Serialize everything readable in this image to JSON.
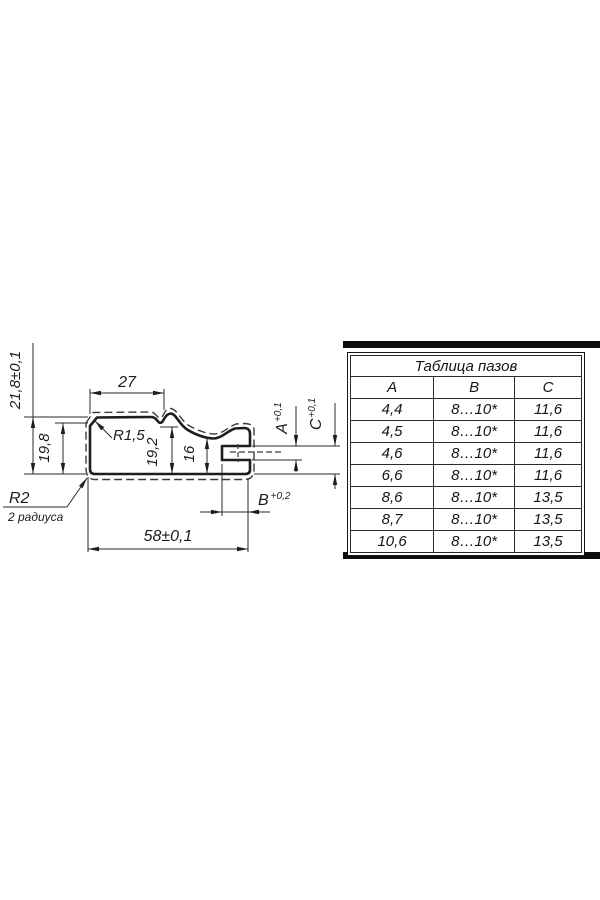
{
  "meta": {
    "background": "#ffffff",
    "line_color": "#1e1e1e",
    "description": "profile-cross-section-drawing"
  },
  "drawing": {
    "dims": {
      "height_total": "21,8±0,1",
      "height_left": "19,8",
      "top_width": "27",
      "radius_top": "R1,5",
      "step_height": "19,2",
      "nose_height": "16",
      "slot_a": {
        "letter": "A",
        "tol": "+0,1"
      },
      "slot_c": {
        "letter": "C",
        "tol": "+0,1"
      },
      "slot_b": {
        "letter": "B",
        "tol": "+0,2"
      },
      "bottom_width": "58±0,1",
      "radius_bottom": "R2",
      "radius_note": "2 радиуса"
    }
  },
  "table": {
    "title": "Таблица пазов",
    "columns": [
      "A",
      "B",
      "C"
    ],
    "rows": [
      [
        "4,4",
        "8…10*",
        "11,6"
      ],
      [
        "4,5",
        "8…10*",
        "11,6"
      ],
      [
        "4,6",
        "8…10*",
        "11,6"
      ],
      [
        "6,6",
        "8…10*",
        "11,6"
      ],
      [
        "8,6",
        "8…10*",
        "13,5"
      ],
      [
        "8,7",
        "8…10*",
        "13,5"
      ],
      [
        "10,6",
        "8…10*",
        "13,5"
      ]
    ]
  }
}
